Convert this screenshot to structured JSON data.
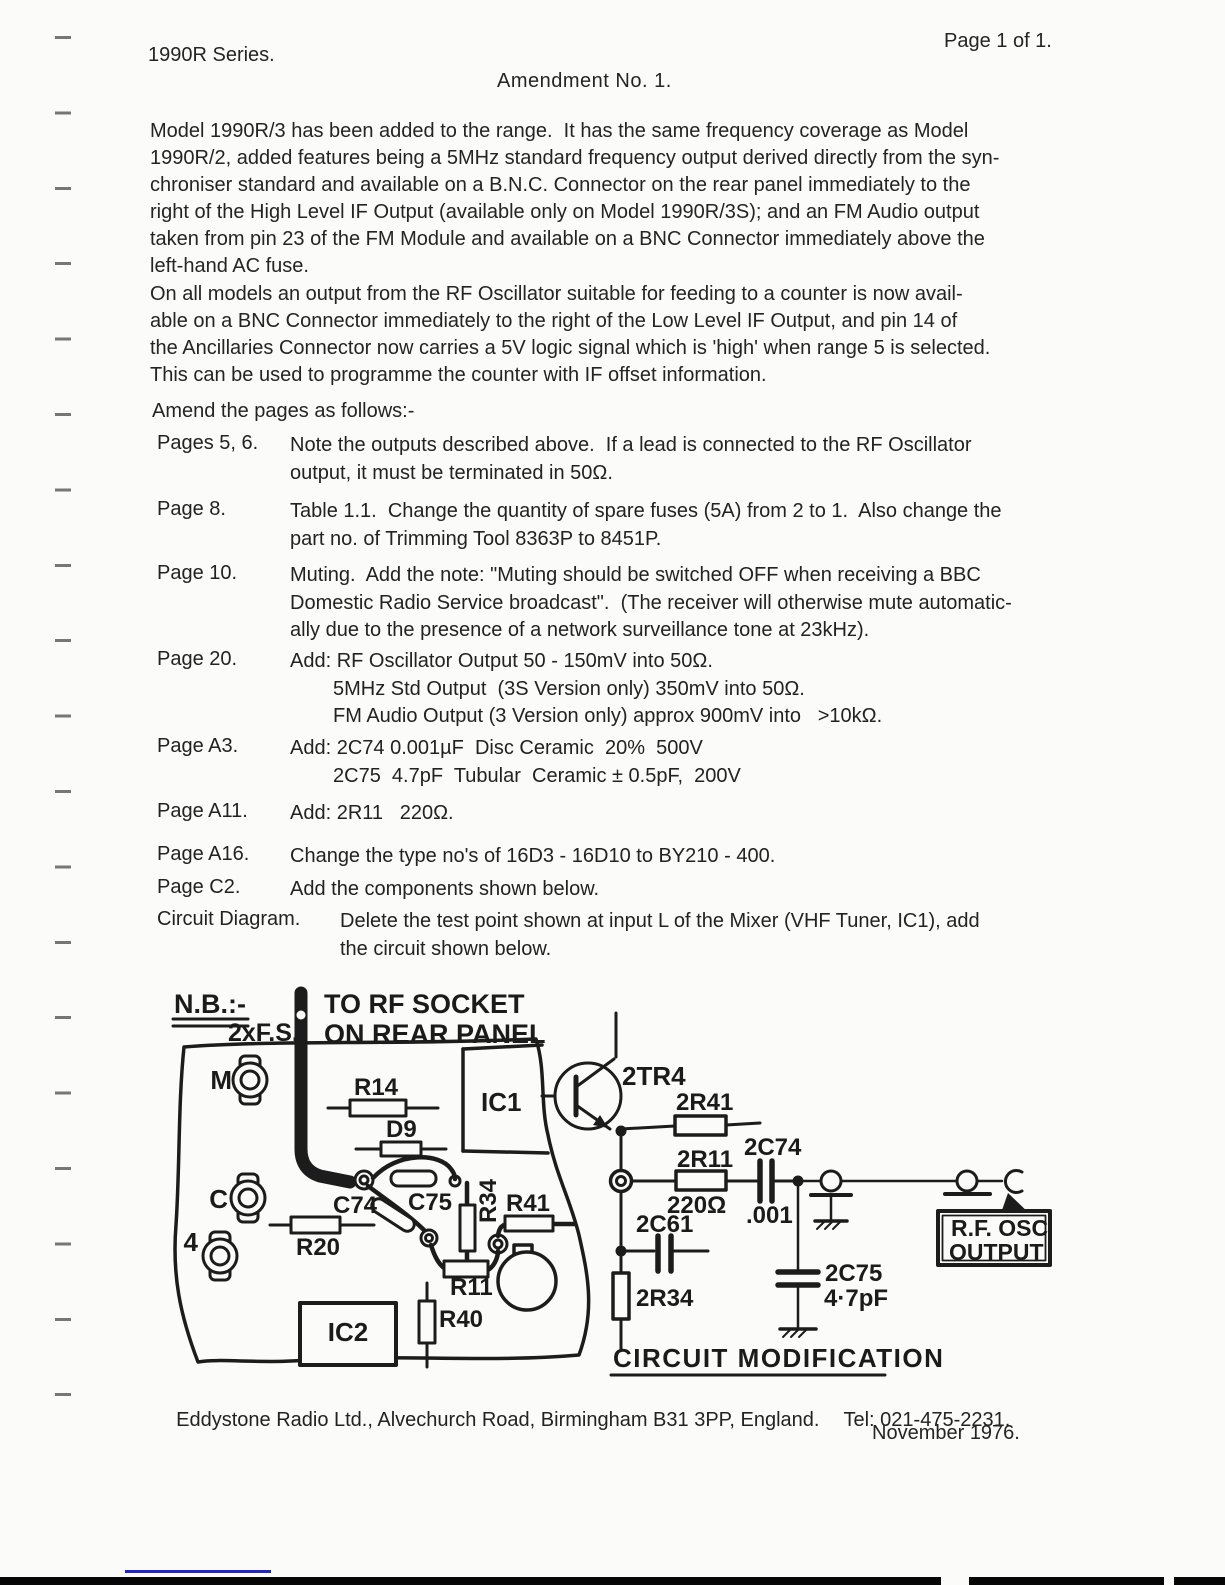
{
  "header": {
    "series": "1990R Series.",
    "page_label": "Page 1 of 1.",
    "title": "Amendment No. 1."
  },
  "paragraphs": {
    "p1_lines": [
      "Model 1990R/3 has been added to the range.  It has the same frequency coverage as Model",
      "1990R/2, added features being a 5MHz standard frequency output derived directly from the syn-",
      "chroniser standard and available on a B.N.C. Connector on the rear panel immediately to the",
      "right of the High Level IF Output (available only on Model 1990R/3S); and an FM Audio output",
      "taken from pin 23 of the FM Module and available on a BNC Connector immediately above the",
      "left-hand AC fuse."
    ],
    "p2_lines": [
      "On all models an output from the RF Oscillator suitable for feeding to a counter is now avail-",
      "able on a BNC Connector immediately to the right of the Low Level IF Output, and pin 14 of",
      "the Ancillaries Connector now carries a 5V logic signal which is 'high' when range 5 is selected.",
      "This can be used to programme the counter with IF offset information."
    ],
    "amend_intro": "Amend the pages as follows:-"
  },
  "amendments": [
    {
      "label": "Pages 5, 6.",
      "lines": [
        "Note the outputs described above.  If a lead is connected to the RF Oscillator",
        "output, it must be terminated in 50Ω."
      ]
    },
    {
      "label": "Page 8.",
      "lines": [
        "Table 1.1.  Change the quantity of spare fuses (5A) from 2 to 1.  Also change the",
        "part no. of Trimming Tool 8363P to 8451P."
      ]
    },
    {
      "label": "Page 10.",
      "lines": [
        "Muting.  Add the note: \"Muting should be switched OFF when receiving a BBC",
        "Domestic Radio Service broadcast\".  (The receiver will otherwise mute automatic-",
        "ally due to the presence of a network surveillance tone at 23kHz)."
      ]
    },
    {
      "label": "Page 20.",
      "lines": [
        "Add: RF Oscillator Output 50 - 150mV into 50Ω.",
        "5MHz Std Output  (3S Version only) 350mV into 50Ω.",
        "FM Audio Output (3 Version only) approx 900mV into   >10kΩ."
      ]
    },
    {
      "label": "Page A3.",
      "lines": [
        "Add: 2C74 0.001µF  Disc Ceramic  20%  500V",
        "2C75  4.7pF  Tubular  Ceramic ± 0.5pF,  200V"
      ]
    },
    {
      "label": "Page A11.",
      "lines": [
        "Add: 2R11   220Ω."
      ]
    },
    {
      "label": "Page A16.",
      "lines": [
        "Change the type no's of 16D3 - 16D10 to BY210 - 400."
      ]
    },
    {
      "label": "Page C2.",
      "lines": [
        "Add the components shown below."
      ]
    },
    {
      "label": "Circuit Diagram.",
      "lines": [
        "Delete the test point shown at input L of the Mixer (VHF Tuner, IC1), add",
        "the circuit shown below."
      ]
    }
  ],
  "diagram": {
    "nb": "N.B.:-",
    "fs": "2xF.S.",
    "torf1": "TO RF SOCKET",
    "torf2": "ON REAR PANEL",
    "hole_m": "M",
    "hole_c": "C",
    "hole_4": "4",
    "r14": "R14",
    "d9": "D9",
    "c74": "C74",
    "c75": "C75",
    "r20": "R20",
    "r34": "R34",
    "r41": "R41",
    "r11": "R11",
    "r40": "R40",
    "ic1": "IC1",
    "ic2": "IC2",
    "tr4": "2TR4",
    "r41s": "2R41",
    "r11s": "2R11",
    "r11s_val": "220Ω",
    "c74s": "2C74",
    "c74s_val": ".001",
    "c61s": "2C61",
    "r34s": "2R34",
    "c75s": "2C75",
    "c75s_val": "4·7pF",
    "out1": "R.F. OSC",
    "out2": "OUTPUT",
    "caption": "CIRCUIT MODIFICATION"
  },
  "footer": {
    "address": "Eddystone Radio Ltd., Alvechurch Road, Birmingham B31 3PP, England.",
    "tel": "Tel: 021-475-2231.",
    "date": "November 1976."
  }
}
